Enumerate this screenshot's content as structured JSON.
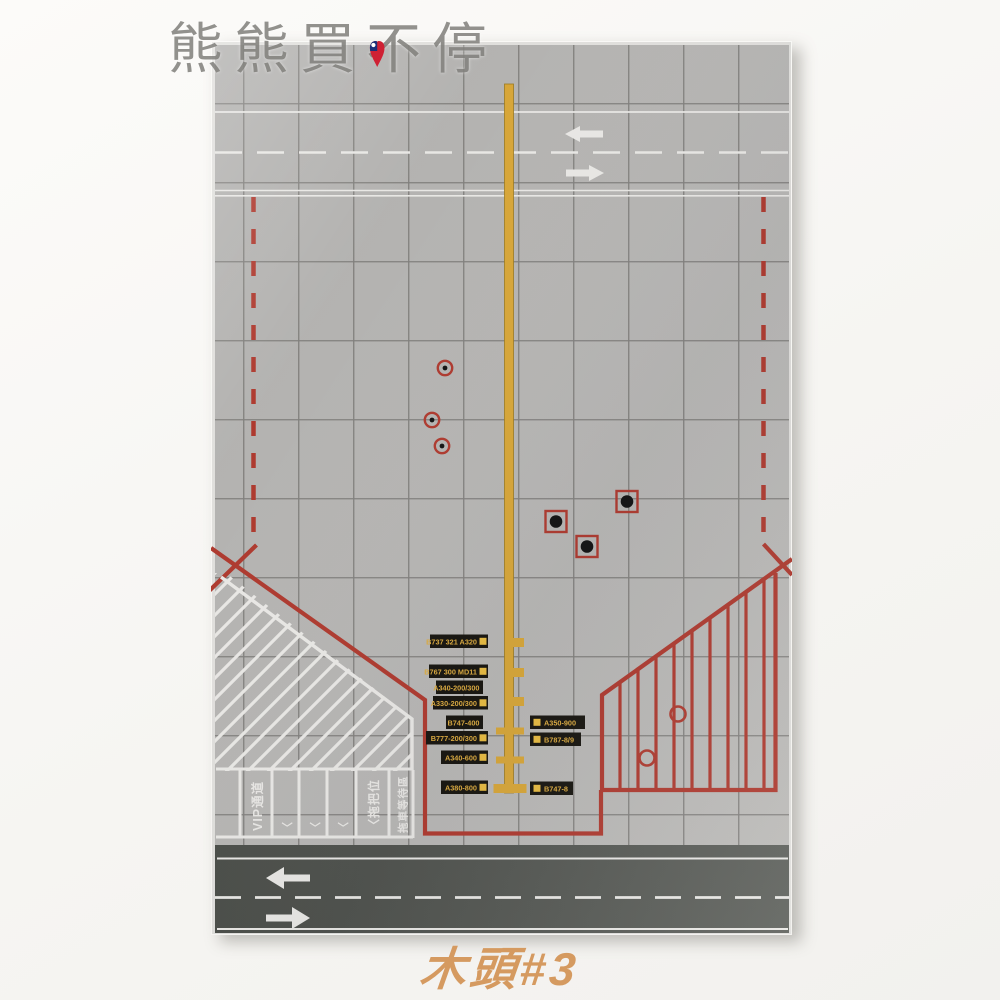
{
  "colors": {
    "page_bg": "#f8f7f4",
    "mat_gray": "#b5b4b2",
    "mat_edge": "#e0dfdc",
    "grid_line": "#73726f",
    "apron_red": "#ae3a2f",
    "centerline_yellow": "#d7a638",
    "centerline_edge": "#9c7a1f",
    "marking_white": "#e8e7e4",
    "road_dark": "#51544f",
    "label_bg": "#17150f",
    "label_text": "#dcab3f",
    "label_square": "#e7bb41",
    "marker_black": "#131313",
    "watermark_gray": "#84837f",
    "caption_orange": "#d59a60",
    "flag_red": "#cf2134",
    "flag_blue": "#1b2f78"
  },
  "watermark": {
    "text": "熊熊買不停"
  },
  "caption": {
    "text": "木頭#3"
  },
  "mat": {
    "labels_left": [
      {
        "text": "B737 321 A320"
      },
      {
        "text": "B767 300 MD11"
      },
      {
        "text": "A340-200/300"
      },
      {
        "text": "A330-200/300"
      },
      {
        "text": "B747-400"
      },
      {
        "text": "B777-200/300"
      },
      {
        "text": "A340-600"
      },
      {
        "text": "A380-800"
      }
    ],
    "labels_right": [
      {
        "text": "A350-900"
      },
      {
        "text": "B787-8/9"
      },
      {
        "text": "B747-8"
      }
    ],
    "stands": {
      "vip_lane": "VIP通道",
      "chevron_1": "〈",
      "chevron_2": "〈",
      "chevron_3": "〈",
      "tug_position": "〈拖把位",
      "tug_wait_area": "拖車等待區"
    }
  }
}
